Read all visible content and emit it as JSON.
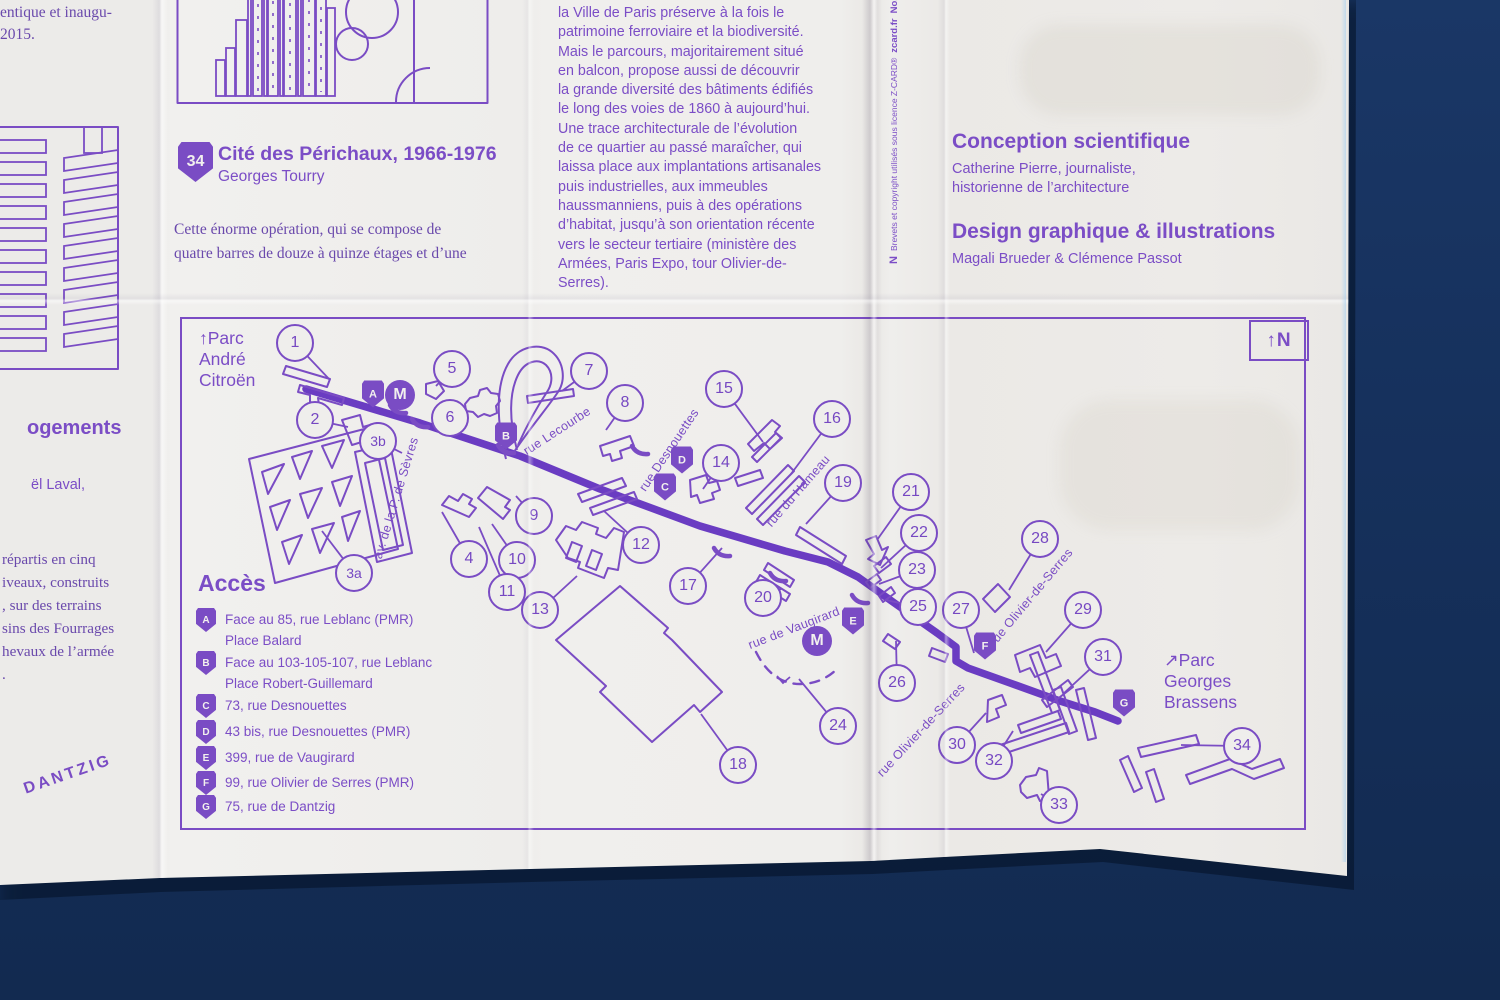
{
  "colors": {
    "background": "#16315d",
    "print_purple": "#7a4cc4",
    "route_purple": "#6a3cc2",
    "paper": "#efeeec"
  },
  "top_left": {
    "fragment": "entique et inaugu-\n2015."
  },
  "perichaux": {
    "badge": "34",
    "title": "Cité des Périchaux, 1966-1976",
    "architect": "Georges Tourry",
    "body": "Cette énorme opération, qui se compose de\nquatre barres de douze à quinze étages et d’une"
  },
  "intro": {
    "text": "la Ville de Paris préserve à la fois le\npatrimoine ferroviaire et la biodiversité.\nMais le parcours, majoritairement situé\nen balcon, propose aussi de découvrir\nla grande diversité des bâtiments édifiés\nle long des voies de 1860 à aujourd’hui.\nUne trace architecturale de l’évolution\nde ce quartier au passé maraîcher, qui\nlaissa place aux implantations artisanales\npuis industrielles, aux immeubles\nhaussmanniens, puis à des opérations\nd’habitat, jusqu’à son orientation récente\nvers le secteur tertiaire (ministère des\nArmées, Paris Expo, tour Olivier-de-\nSerres)."
  },
  "credits": {
    "science_title": "Conception scientifique",
    "science_body": "Catherine Pierre, journaliste,\nhistorienne de l’architecture",
    "design_title": "Design graphique & illustrations",
    "design_body": "Magali Brueder & Clémence Passot"
  },
  "zcard": {
    "logo": "N",
    "text": "Brevets et copyright utilisés sous licence Z-CARD®",
    "site": "zcard.fr",
    "number": "No. 126639/12"
  },
  "left_column": {
    "heading": "ogements",
    "subline": "ël Laval,",
    "body": "répartis en cinq\niveaux, construits\n, sur des terrains\nsins des Fourrages\nhevaux de l’armée\n.",
    "street": "DANTZIG"
  },
  "map": {
    "compass": "↑N",
    "parc_top": "↑Parc\nAndré\nCitroën",
    "parc_bottom": "↗Parc\nGeorges\nBrassens",
    "acces": {
      "title": "Accès",
      "items": [
        {
          "letter": "A",
          "text": "Face au 85, rue Leblanc (PMR)\nPlace Balard",
          "y": 608
        },
        {
          "letter": "B",
          "text": "Face au 103-105-107, rue Leblanc\nPlace Robert-Guillemard",
          "y": 651
        },
        {
          "letter": "C",
          "text": "73, rue Desnouettes",
          "y": 694
        },
        {
          "letter": "D",
          "text": "43 bis, rue Desnouettes (PMR)",
          "y": 720
        },
        {
          "letter": "E",
          "text": "399, rue de Vaugirard",
          "y": 746
        },
        {
          "letter": "F",
          "text": "99, rue Olivier de Serres (PMR)",
          "y": 771
        },
        {
          "letter": "G",
          "text": "75, rue de Dantzig",
          "y": 795
        }
      ]
    },
    "markers": [
      {
        "n": "1",
        "x": 295,
        "y": 343,
        "lx": 330,
        "ly": 380
      },
      {
        "n": "2",
        "x": 315,
        "y": 420,
        "lx": 348,
        "ly": 427
      },
      {
        "n": "3b",
        "x": 378,
        "y": 441,
        "lx": 402,
        "ly": 453
      },
      {
        "n": "3a",
        "x": 354,
        "y": 573,
        "lx": 322,
        "ly": 531
      },
      {
        "n": "4",
        "x": 469,
        "y": 559,
        "lx": 442,
        "ly": 512
      },
      {
        "n": "5",
        "x": 452,
        "y": 369,
        "lx": 436,
        "ly": 386
      },
      {
        "n": "6",
        "x": 450,
        "y": 418,
        "lx": 467,
        "ly": 409
      },
      {
        "n": "7",
        "x": 589,
        "y": 371,
        "lx": 562,
        "ly": 391
      },
      {
        "n": "8",
        "x": 625,
        "y": 403,
        "lx": 606,
        "ly": 430
      },
      {
        "n": "9",
        "x": 534,
        "y": 516,
        "lx": 516,
        "ly": 496
      },
      {
        "n": "10",
        "x": 517,
        "y": 560,
        "lx": 492,
        "ly": 524
      },
      {
        "n": "11",
        "x": 507,
        "y": 592,
        "lx": 479,
        "ly": 527
      },
      {
        "n": "12",
        "x": 641,
        "y": 545,
        "lx": 604,
        "ly": 511
      },
      {
        "n": "13",
        "x": 540,
        "y": 610,
        "lx": 577,
        "ly": 576
      },
      {
        "n": "14",
        "x": 721,
        "y": 463,
        "lx": 703,
        "ly": 489
      },
      {
        "n": "15",
        "x": 724,
        "y": 389,
        "lx": 763,
        "ly": 442
      },
      {
        "n": "16",
        "x": 832,
        "y": 419,
        "lx": 791,
        "ly": 474
      },
      {
        "n": "17",
        "x": 688,
        "y": 586,
        "lx": 722,
        "ly": 548
      },
      {
        "n": "18",
        "x": 738,
        "y": 765,
        "lx": 701,
        "ly": 714
      },
      {
        "n": "19",
        "x": 843,
        "y": 483,
        "lx": 806,
        "ly": 524
      },
      {
        "n": "20",
        "x": 763,
        "y": 598,
        "lx": 781,
        "ly": 589
      },
      {
        "n": "21",
        "x": 911,
        "y": 492,
        "lx": 877,
        "ly": 540
      },
      {
        "n": "22",
        "x": 919,
        "y": 533,
        "lx": 881,
        "ly": 568
      },
      {
        "n": "23",
        "x": 917,
        "y": 570,
        "lx": 879,
        "ly": 584
      },
      {
        "n": "24",
        "x": 838,
        "y": 726,
        "lx": 799,
        "ly": 679
      },
      {
        "n": "25",
        "x": 918,
        "y": 607,
        "lx": 886,
        "ly": 600
      },
      {
        "n": "26",
        "x": 897,
        "y": 683,
        "lx": 896,
        "ly": 641
      },
      {
        "n": "27",
        "x": 961,
        "y": 610,
        "lx": 974,
        "ly": 653
      },
      {
        "n": "28",
        "x": 1040,
        "y": 539,
        "lx": 1009,
        "ly": 590
      },
      {
        "n": "29",
        "x": 1083,
        "y": 610,
        "lx": 1046,
        "ly": 652
      },
      {
        "n": "30",
        "x": 957,
        "y": 745,
        "lx": 986,
        "ly": 713
      },
      {
        "n": "31",
        "x": 1103,
        "y": 657,
        "lx": 1063,
        "ly": 694
      },
      {
        "n": "32",
        "x": 994,
        "y": 761,
        "lx": 1013,
        "ly": 731
      },
      {
        "n": "33",
        "x": 1059,
        "y": 805,
        "lx": 1041,
        "ly": 794
      },
      {
        "n": "34",
        "x": 1242,
        "y": 746,
        "lx": 1181,
        "ly": 745
      }
    ],
    "access_badges": [
      {
        "letter": "A",
        "x": 373,
        "y": 394
      },
      {
        "letter": "B",
        "x": 506,
        "y": 436
      },
      {
        "letter": "C",
        "x": 665,
        "y": 487
      },
      {
        "letter": "D",
        "x": 682,
        "y": 460
      },
      {
        "letter": "E",
        "x": 853,
        "y": 621
      },
      {
        "letter": "F",
        "x": 985,
        "y": 646
      },
      {
        "letter": "G",
        "x": 1124,
        "y": 703
      }
    ],
    "metro": [
      {
        "label": "M",
        "x": 400,
        "y": 395
      },
      {
        "label": "M",
        "x": 817,
        "y": 641
      }
    ],
    "streets": [
      {
        "name": "rue Lecourbe",
        "x": 557,
        "y": 431,
        "angle": -33
      },
      {
        "name": "av. de la P. de Sèvres",
        "x": 396,
        "y": 498,
        "angle": -73
      },
      {
        "name": "rue Desnouettes",
        "x": 669,
        "y": 450,
        "angle": -56
      },
      {
        "name": "rue du Hameau",
        "x": 798,
        "y": 491,
        "angle": -49
      },
      {
        "name": "rue de Vaugirard",
        "x": 794,
        "y": 628,
        "angle": -21
      },
      {
        "name": "rue Olivier-de-Serres",
        "x": 1031,
        "y": 597,
        "angle": -50
      },
      {
        "name": "rue Olivier-de-Serres",
        "x": 921,
        "y": 730,
        "angle": -47
      }
    ]
  }
}
